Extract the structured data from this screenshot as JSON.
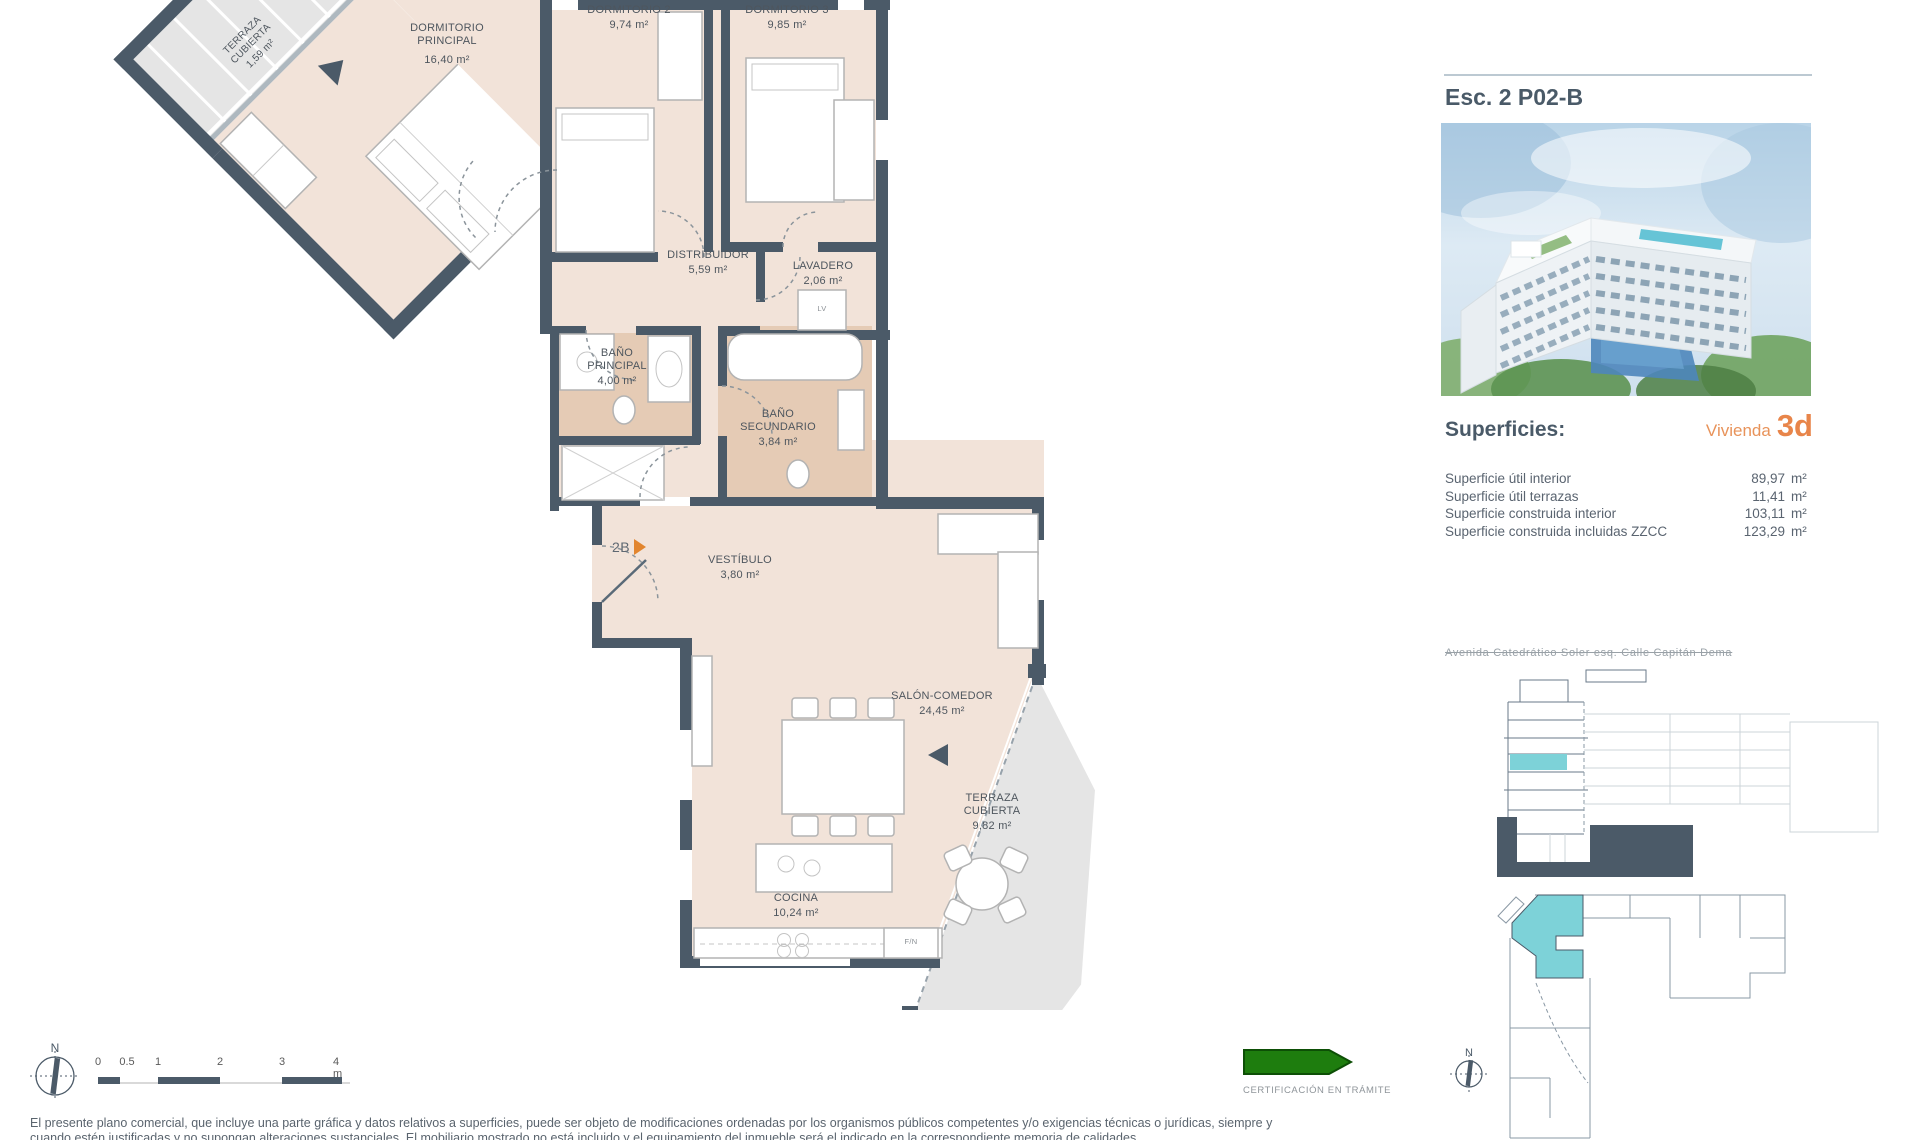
{
  "title": "Esc. 2 P02-B",
  "superficies": {
    "heading": "Superficies:",
    "vivienda_label": "Vivienda",
    "vivienda_code": "3d",
    "rows": [
      {
        "label": "Superficie útil interior",
        "value": "89,97",
        "unit": "m²"
      },
      {
        "label": "Superficie útil terrazas",
        "value": "11,41",
        "unit": "m²"
      },
      {
        "label": "Superficie construida interior",
        "value": "103,11",
        "unit": "m²"
      },
      {
        "label": "Superficie construida incluidas ZZCC",
        "value": "123,29",
        "unit": "m²"
      }
    ]
  },
  "location_caption": "Avenida Catedrático Soler esq. Calle Capitán Dema",
  "plan": {
    "entry": {
      "code": "2B"
    },
    "rooms": {
      "terraza_norte": {
        "l1": "TERRAZA",
        "l2": "CUBIERTA",
        "area": "1,59 m²"
      },
      "dormitorio_principal": {
        "l1": "DORMITORIO",
        "l2": "PRINCIPAL",
        "area": "16,40 m²"
      },
      "dormitorio_2": {
        "l1": "DORMITORIO 2",
        "area": "9,74 m²"
      },
      "dormitorio_3": {
        "l1": "DORMITORIO 3",
        "area": "9,85 m²"
      },
      "distribuidor": {
        "l1": "DISTRIBUIDOR",
        "area": "5,59 m²"
      },
      "lavadero": {
        "l1": "LAVADERO",
        "area": "2,06 m²"
      },
      "bano_principal": {
        "l1": "BAÑO",
        "l2": "PRINCIPAL",
        "area": "4,00 m²"
      },
      "bano_secundario": {
        "l1": "BAÑO",
        "l2": "SECUNDARIO",
        "area": "3,84 m²"
      },
      "vestibulo": {
        "l1": "VESTÍBULO",
        "area": "3,80 m²"
      },
      "salon_comedor": {
        "l1": "SALÓN-COMEDOR",
        "area": "24,45 m²"
      },
      "terraza_sur": {
        "l1": "TERRAZA",
        "l2": "CUBIERTA",
        "area": "9,82 m²"
      },
      "cocina": {
        "l1": "COCINA",
        "area": "10,24 m²"
      }
    },
    "appliances": {
      "kitchen_fridge": "F/N",
      "laundry": "LV"
    }
  },
  "scalebar": {
    "ticks": [
      "0",
      "0.5",
      "1",
      "2",
      "3",
      "4 m"
    ]
  },
  "compass": {
    "north_label": "N"
  },
  "certification": {
    "label": "CERTIFICACIÓN EN TRÁMITE"
  },
  "disclaimer": {
    "line1": "El presente plano comercial, que incluye una parte gráfica y datos relativos a superficies, puede ser objeto de modificaciones ordenadas por los organismos públicos competentes y/o exigencias técnicas o jurídicas, siempre y",
    "line2": "cuando estén justificadas y no supongan alteraciones sustanciales. El mobiliario mostrado no está incluido y el equipamiento del inmueble será el indicado en la correspondiente memoria de calidades."
  },
  "colors": {
    "wall": "#4b5a68",
    "floor": "#f2e3d9",
    "bath_floor": "#e5cbb5",
    "terrace": "#e5e5e5",
    "accent_orange": "#e2852e",
    "highlight_teal": "#7dd2d8",
    "cert_green": "#1e7d0e"
  }
}
